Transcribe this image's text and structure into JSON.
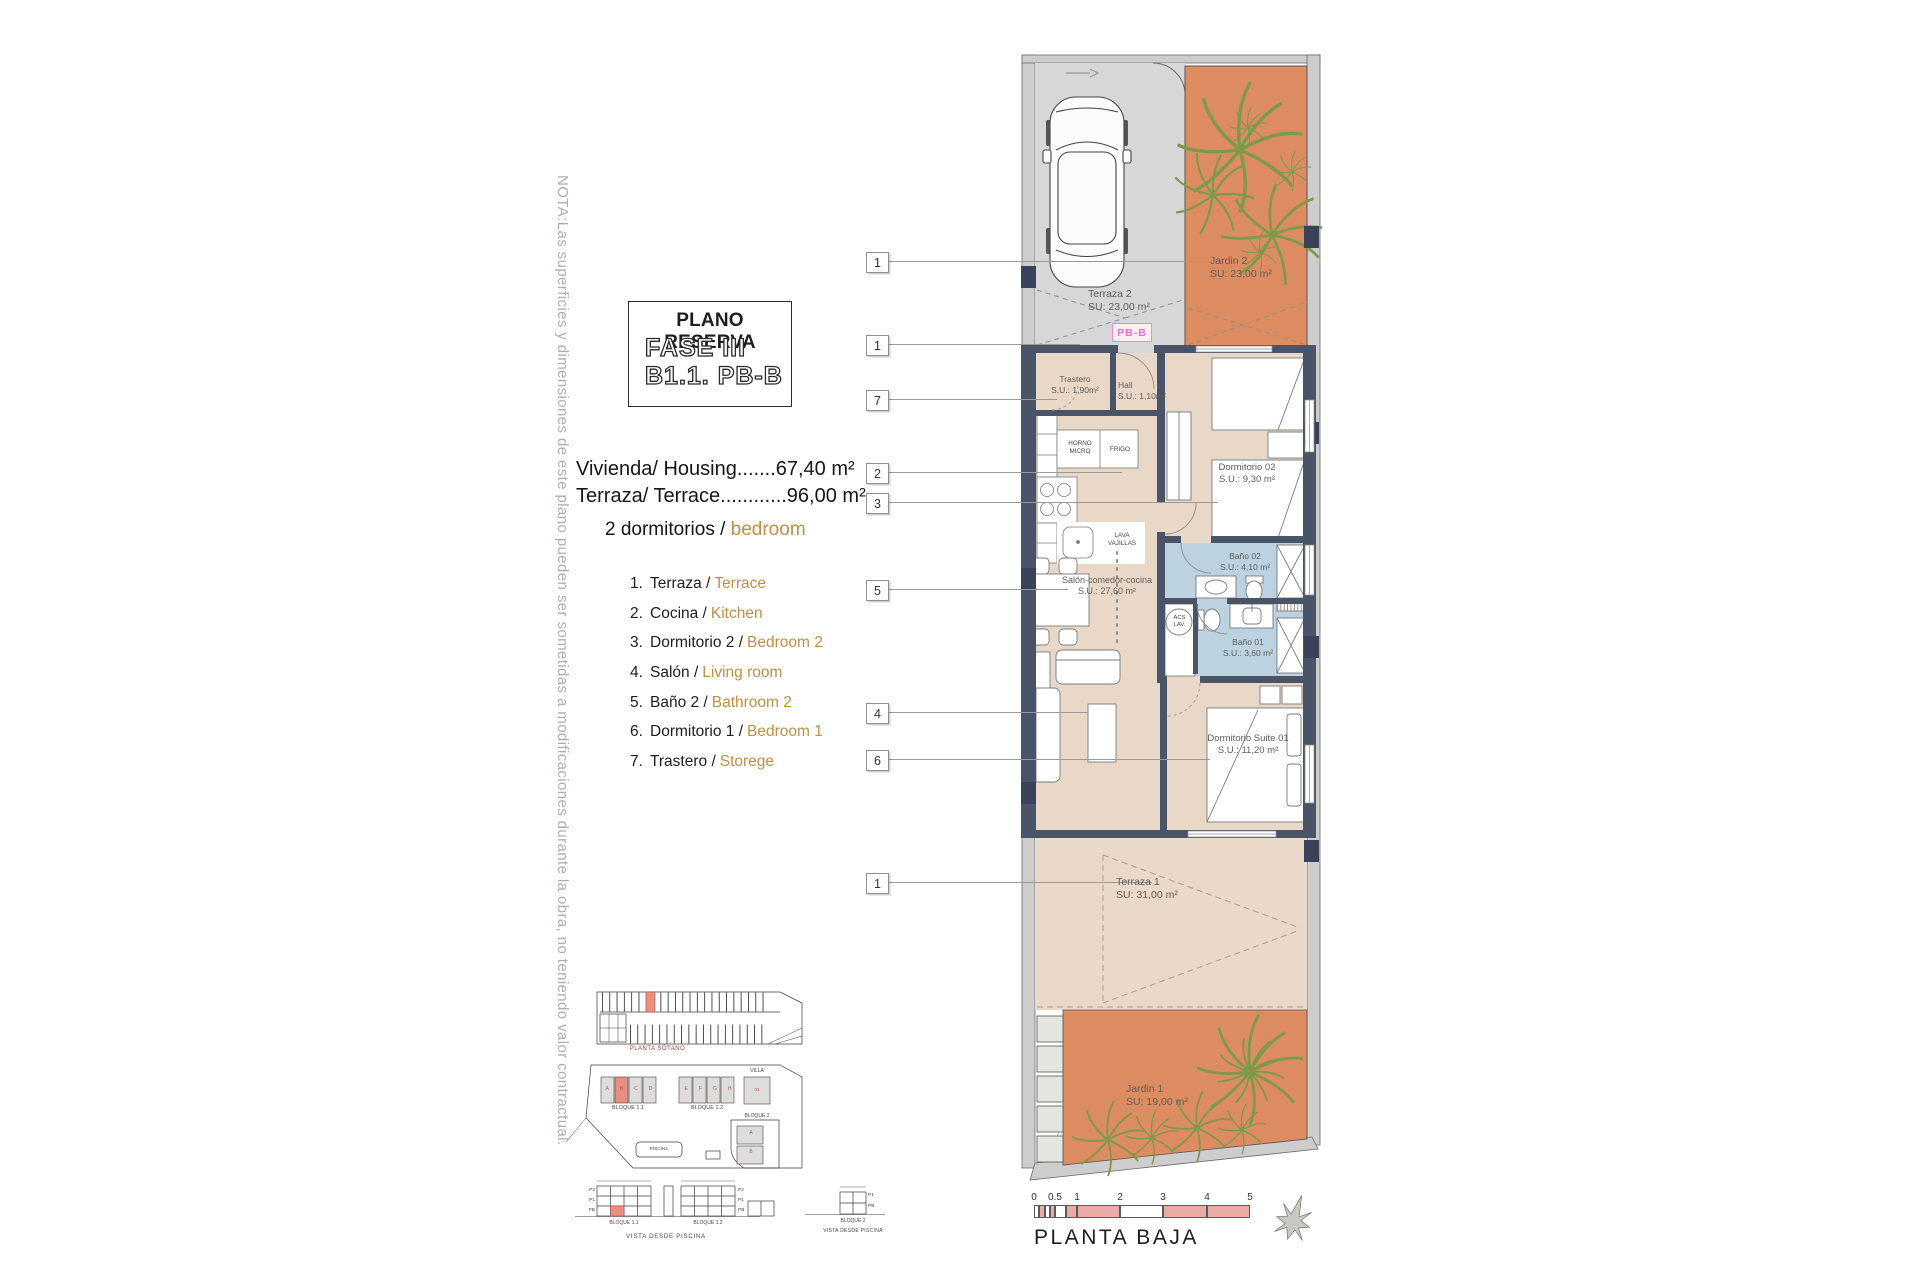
{
  "note": "NOTA:Las superficies y dimensiones de este plano pueden ser sometidas a modificaciones durante la obra, no teniendo valor contractual.",
  "title_block": {
    "line1": "PLANO RESERVA",
    "line2": "FASE III",
    "line3": "B1.1. PB-B"
  },
  "areas": {
    "housing": "Vivienda/ Housing.......67,40 m²",
    "terrace": "Terraza/ Terrace............96,00 m²"
  },
  "bedrooms": {
    "es": "2 dormitorios /",
    "en": "bedroom"
  },
  "legend": {
    "items": [
      {
        "num": "1.",
        "es": "Terraza /",
        "en": "Terrace"
      },
      {
        "num": "2.",
        "es": "Cocina /",
        "en": "Kitchen"
      },
      {
        "num": "3.",
        "es": "Dormitorio 2 /",
        "en": "Bedroom 2"
      },
      {
        "num": "4.",
        "es": "Salón /",
        "en": "Living room"
      },
      {
        "num": "5.",
        "es": "Baño 2 /",
        "en": "Bathroom 2"
      },
      {
        "num": "6.",
        "es": "Dormitorio 1 /",
        "en": "Bedroom 1"
      },
      {
        "num": "7.",
        "es": "Trastero /",
        "en": "Storege"
      }
    ]
  },
  "callouts": [
    "1",
    "1",
    "7",
    "2",
    "3",
    "5",
    "4",
    "6",
    "1"
  ],
  "plan": {
    "unit_tag": "PB-B",
    "labels": {
      "terraza2": "Terraza 2\nSU: 23,00 m²",
      "jardin2": "Jardin 2\nSU: 23,00 m²",
      "trastero": "Trastero\nS.U.: 1,90m²",
      "hall": "Hall\nS.U.: 1,10m²",
      "horno": "HORNO\nMICRO",
      "frigo": "FRIGO",
      "lava": "LAVA\nVAJILLAS",
      "acs": "ACS\nLAV.",
      "dormitorio02": "Dormitorio 02\nS.U.: 9,30 m²",
      "bano02": "Baño 02\nS.U.: 4,10 m²",
      "bano01": "Baño 01\nS.U.: 3,60 m²",
      "salon": "Salón-comedor-cocina\nS.U.: 27,60 m²",
      "suite": "Dormitorio Suite 01\nS.U.: 11,20 m²",
      "terraza1": "Terraza 1\nSU: 31,00 m²",
      "jardin1": "Jardin 1\nSU: 19,00 m²"
    }
  },
  "site": {
    "sotano": "PLANTA SÓTANO",
    "bloque11": "BLOQUE 1.1",
    "bloque12": "BLOQUE 1.2",
    "villa": "VILLA",
    "villa_unit": "01",
    "bloque2": "BLOQUE 2",
    "piscina": "PISCINA",
    "units_b11": [
      "A",
      "B",
      "C",
      "D"
    ],
    "units_b12": [
      "E",
      "F",
      "G",
      "H"
    ],
    "bloque2_units": [
      "A",
      "B"
    ],
    "floors": [
      "P2",
      "P1",
      "PB"
    ],
    "floors_b2": [
      "P1",
      "PB"
    ],
    "vista": "VISTA DESDE PISCINA"
  },
  "scalebar": {
    "ticks": [
      "0",
      "0.5",
      "1",
      "2",
      "3",
      "4",
      "5"
    ],
    "label": "PLANTA BAJA"
  },
  "colors": {
    "garden": "#dd8c61",
    "interior": "#e9d8c7",
    "terrace_gray": "#d7d7d7",
    "wall": "#4a5468",
    "bath": "#bcd2e0",
    "highlight": "#ea8e80",
    "accent_text": "#bf8f45",
    "scale_pink": "#e9aca4",
    "plant_green": "#7d9a49",
    "tag_pink": "#ee6fc8"
  }
}
